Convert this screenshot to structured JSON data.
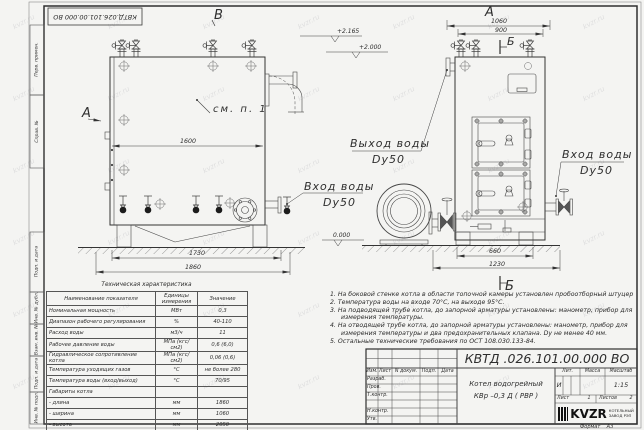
{
  "sheet": {
    "doc_number_top": "КВТД.026.101.00.000  ВО",
    "format_label": "Формат",
    "format_value": "А3",
    "watermark": "kvzr.ru"
  },
  "frame_columns": {
    "perv_primen": "Перв. примен.",
    "sprav_no": "Справ. №",
    "podp_data1": "Подп. и дата",
    "inv_dubl": "Инв. № дубл.",
    "vzam_inv": "Взам. инв. №",
    "podp_data2": "Подп. и дата",
    "inv_podl": "Инв. № подл."
  },
  "views": {
    "view_b_label": "В",
    "view_a_arrow_label": "А",
    "front_view_label": "А",
    "section_b_top": "Б",
    "section_b_bottom": "Б",
    "callout_see_item": "см. п. 1",
    "outlet_line1": "Выход воды",
    "outlet_line2": "Dy50",
    "inlet_left_line1": "Вход воды",
    "inlet_left_line2": "Dy50",
    "inlet_right_line1": "Вход воды",
    "inlet_right_line2": "Dy50"
  },
  "dimensions": {
    "side_width": "1600",
    "side_base": "1730",
    "side_total": "1860",
    "front_total": "1060",
    "front_inner": "900",
    "front_base": "660",
    "front_full": "1230"
  },
  "elevations": {
    "top": "+2.165",
    "mid": "+2.000",
    "zero": "0.000"
  },
  "tech_table": {
    "title": "Техническая характеристика",
    "headers": [
      "Наименование показателя",
      "Единицы измерения",
      "Значение"
    ],
    "rows": [
      [
        "Номинальная мощность",
        "МВт",
        "0,3"
      ],
      [
        "Диапазон рабочего регулирования",
        "%",
        "40-110"
      ],
      [
        "Расход воды",
        "м3/ч",
        "11"
      ],
      [
        "Рабочее давление воды",
        "МПа (кгс/см2)",
        "0,6 (6,0)"
      ],
      [
        "Гидравлическое сопротивление котла",
        "МПа (кгс/см2)",
        "0,06 (0,6)"
      ],
      [
        "Температура уходящих газов",
        "°С",
        "не более 280"
      ],
      [
        "Температура воды (вход/выход)",
        "°С",
        "70/95"
      ],
      [
        "Габариты котла",
        "",
        ""
      ],
      [
        "   - длина",
        "мм",
        "1860"
      ],
      [
        "   - ширина",
        "мм",
        "1060"
      ],
      [
        "   - высота",
        "мм",
        "2050"
      ]
    ]
  },
  "notes": {
    "items": [
      "1.  На боковой стенке котла в области топочной камеры установлен пробоотборный штуцер",
      "2.  Температура воды на входе 70°С, на выходе 95°С.",
      "3.  На подводящей трубе котла, до запорной арматуры установлены: манометр, прибор для измерения температуры.",
      "4.  На отводящей трубе котла, до запорной арматуры установлены: манометр, прибор для измерения температуры и два предохранительных клапана. Dу не менее 40 мм.",
      "5.  Остальные технические требования по ОСТ 108.030.133-84."
    ]
  },
  "title_block": {
    "doc_number": "КВТД .026.101.00.000  ВО",
    "product_line1": "Котел водогрейный",
    "product_line2": "КВр –0,3 Д  ( РВР )",
    "col_izm": "Изм.",
    "col_list": "Лист",
    "col_ndoc": "N докум.",
    "col_podp": "Подп.",
    "col_data": "Дата",
    "row_razrab": "Разраб.",
    "row_prov": "Пров.",
    "row_tkontr": "Т.контр.",
    "row_nkontr": "Н.контр.",
    "row_utv": "Утв.",
    "lit_label": "Лит.",
    "mass_label": "Масса",
    "scale_label": "Масштаб",
    "lit_value": "И",
    "scale_value": "1:15",
    "sheet_label": "Лист",
    "sheet_value": "1",
    "sheets_label": "Листов",
    "sheets_value": "2",
    "company": "KVZR",
    "company_sub1": "КОТЕЛЬНЫЙ",
    "company_sub2": "ЗАВОД РЭП"
  }
}
